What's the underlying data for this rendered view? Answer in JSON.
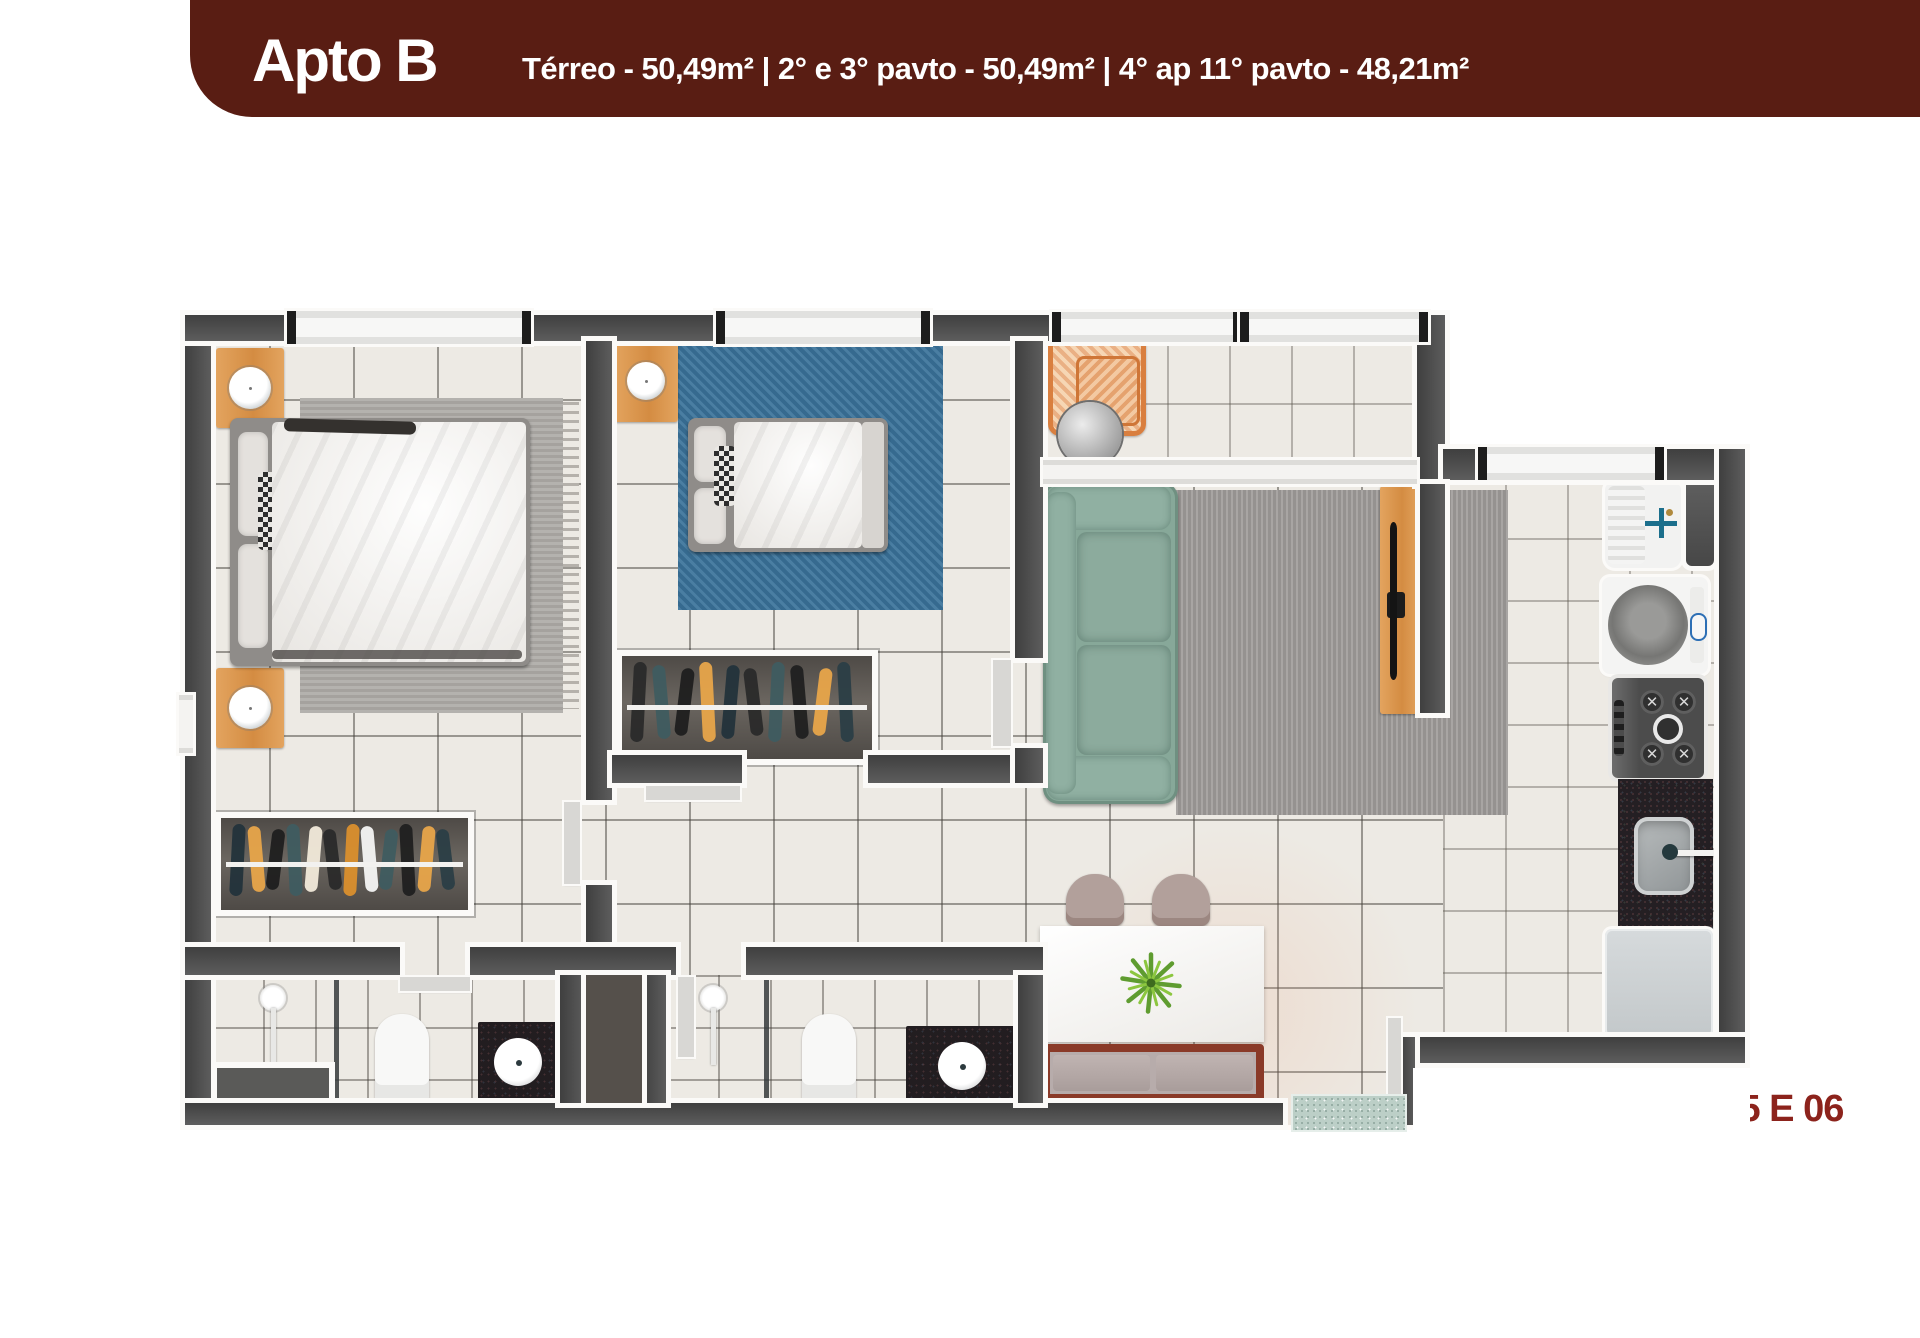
{
  "header": {
    "title": "Apto B",
    "subtitle": "Térreo - 50,49m² | 2° e 3° pavto - 50,49m² | 4° ap 11° pavto - 48,21m²"
  },
  "caption": "COLUNA 03,04,05 E 06",
  "colors": {
    "banner_bg": "#591d13",
    "banner_text": "#ffffff",
    "caption_text": "#8c231c",
    "wall": "#484848",
    "wall_trim": "#fbfaf8",
    "floor_tile": "#edeae4",
    "bedroom_rug_gray": "#aeaba7",
    "bedroom2_rug_blue": "#3c749b",
    "living_rug_gray": "#9e9b99",
    "sofa_green": "#87a899",
    "wood_furniture": "#dd9a55",
    "bench_wood": "#8a3a28",
    "plant_green": "#6fae3e",
    "doormat_teal": "#bccfc7",
    "kitchen_counter": "#241f23",
    "stove_gray": "#565656",
    "fridge_gray": "#cdd1d3"
  },
  "closets": {
    "master_clothes": [
      "#23333b",
      "#e6a44a",
      "#1f1f1f",
      "#3f5c60",
      "#f0e8d8",
      "#2b2b2b",
      "#d98f2e",
      "#f4f4f2",
      "#3f5c60",
      "#202020",
      "#e6a44a",
      "#2c3e46"
    ],
    "bedroom2_clothes": [
      "#2b2b2b",
      "#3f5c60",
      "#1f1f1f",
      "#e6a44a",
      "#23333b",
      "#2b2b2b",
      "#3f5c60",
      "#202020",
      "#e6a44a",
      "#2c3e46"
    ]
  }
}
